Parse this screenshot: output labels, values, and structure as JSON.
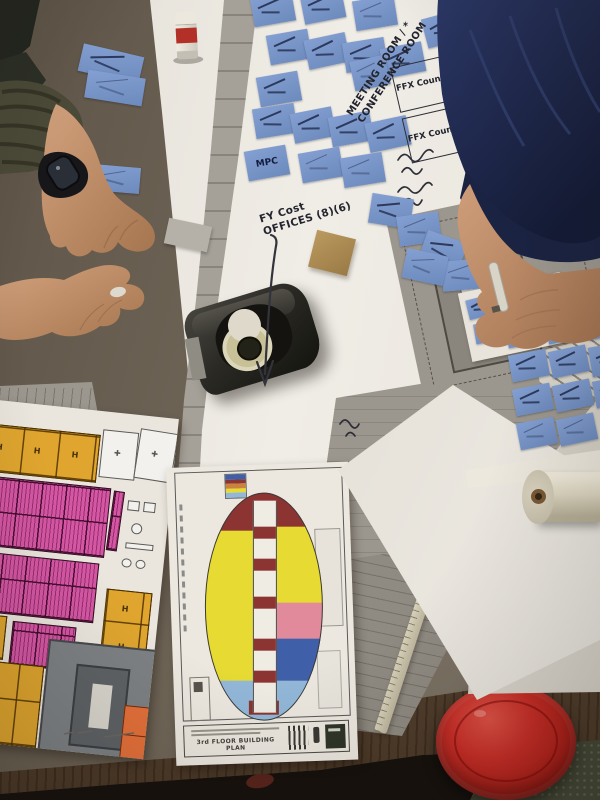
{
  "scene_labels": {
    "meeting_room_line1": "MEETING ROOM / *",
    "meeting_room_line2": "CONFERENCE ROOM",
    "ffx_box1": "FFX County",
    "ffx_box2": "FFX County",
    "fy_line1": "FY Cost",
    "fy_line2": "OFFICES (8)(6)",
    "mpc_note": "MPC"
  },
  "printed_plan": {
    "title": "3rd FLOOR BUILDING PLAN"
  },
  "palette": {
    "table": "#6e6356",
    "paper": "#e9e5dd",
    "note": "#84a0d3",
    "noteDark": "#6d8abc",
    "ink": "#23242e",
    "printGray": "#9c978e",
    "wood": "#5a4633",
    "floor": "#16110d",
    "carpet": "#454a37",
    "sleeveNavy": "#1e2848",
    "sleeveOlive": "#4f4d3b",
    "skin": "#c79a77",
    "maroon": "#8c3431",
    "planYellow": "#e6da33",
    "planPink": "#e08a9b",
    "planBlue": "#3f5fa8",
    "planLtBlue": "#92b7d8",
    "amber": "#dfa52e",
    "magenta": "#d457a4",
    "orange": "#e4703a",
    "cupRed": "#c0241e",
    "tape": "#c8c097",
    "cardboard": "#b08d55"
  }
}
